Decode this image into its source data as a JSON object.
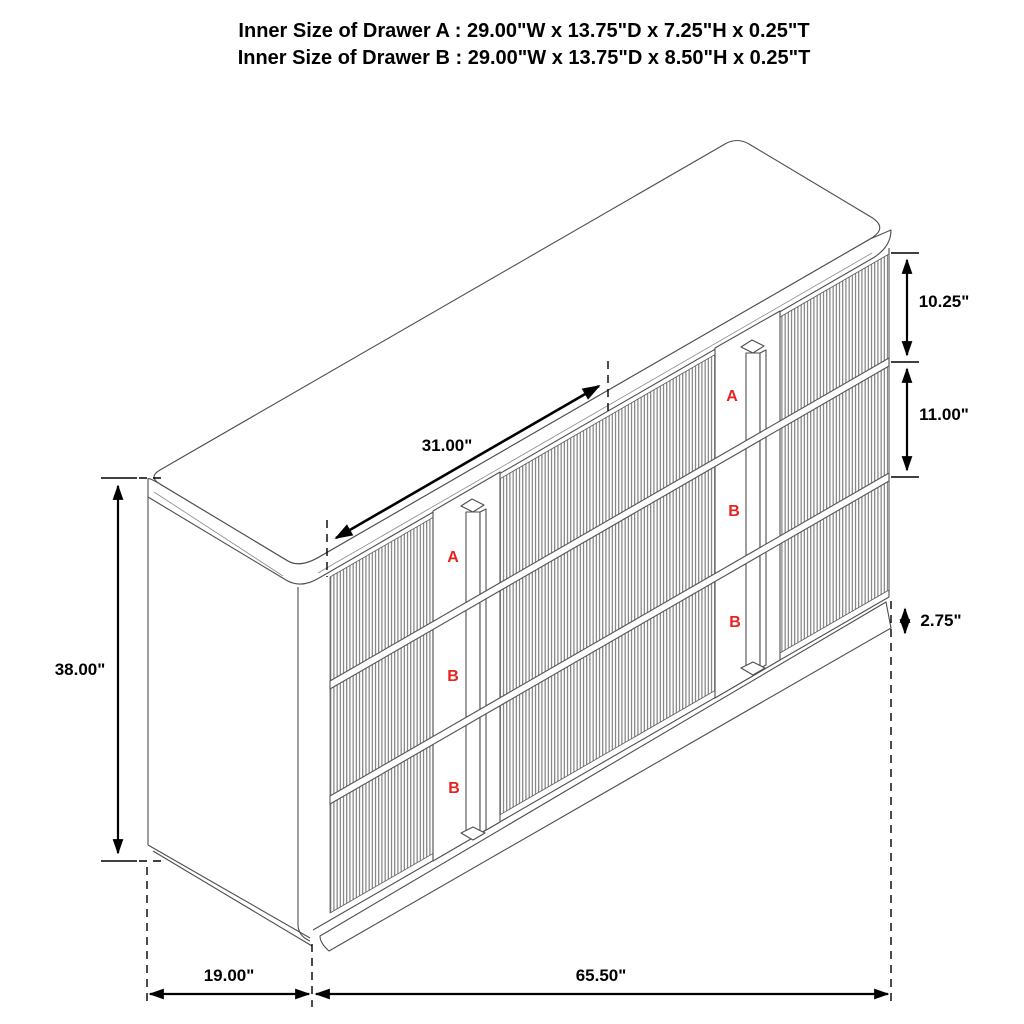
{
  "title": {
    "line1": "Inner Size of Drawer A : 29.00\"W x 13.75\"D x 7.25\"H x 0.25\"T",
    "line2": "Inner Size of Drawer B : 29.00\"W x 13.75\"D x 8.50\"H x 0.25\"T"
  },
  "dimensions": {
    "drawer_a_height": "10.25\"",
    "drawer_b_height": "11.00\"",
    "base_height": "2.75\"",
    "overall_height": "38.00\"",
    "drawer_front_width": "31.00\"",
    "depth": "19.00\"",
    "width": "65.50\""
  },
  "drawer_labels": {
    "left_column": [
      "A",
      "B",
      "B"
    ],
    "right_column": [
      "A",
      "B",
      "B"
    ]
  },
  "colors": {
    "furniture_line": "#4e4e4e",
    "dimension_line": "#000000",
    "drawer_label_red": "#e8221f"
  }
}
